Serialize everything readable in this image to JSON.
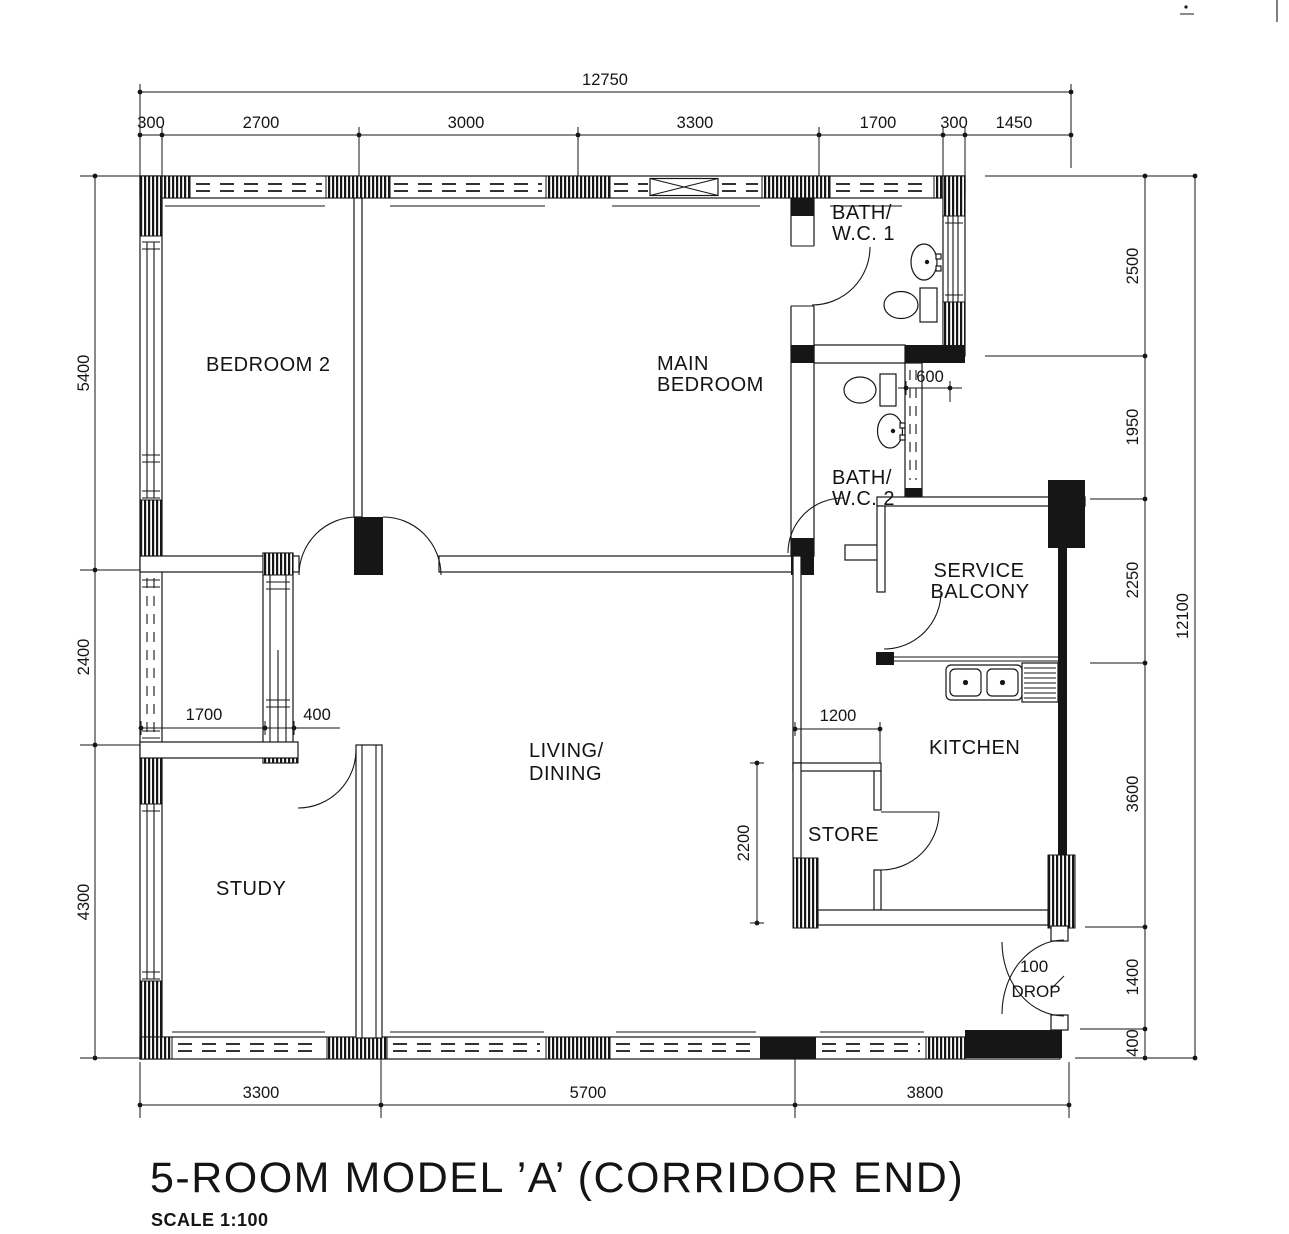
{
  "drawing": {
    "title": "5-ROOM MODEL ’A’ (CORRIDOR END)",
    "scale_label": "SCALE 1:100"
  },
  "rooms": {
    "bedroom2": "BEDROOM 2",
    "main_bedroom_line1": "MAIN",
    "main_bedroom_line2": "BEDROOM",
    "bath1_line1": "BATH/",
    "bath1_line2": "W.C. 1",
    "bath2_line1": "BATH/",
    "bath2_line2": "W.C. 2",
    "service_balcony_line1": "SERVICE",
    "service_balcony_line2": "BALCONY",
    "kitchen": "KITCHEN",
    "store": "STORE",
    "living_line1": "LIVING/",
    "living_line2": "DINING",
    "study": "STUDY",
    "entrance_drop_line1": "100",
    "entrance_drop_line2": "DROP"
  },
  "dimensions": {
    "top_total": "12750",
    "top_segments": [
      "300",
      "2700",
      "3000",
      "3300",
      "1700",
      "300",
      "1450"
    ],
    "left": [
      "5400",
      "2400",
      "4300"
    ],
    "right": [
      "2500",
      "1950",
      "2250",
      "3600",
      "1400",
      "400"
    ],
    "right_total": "12100",
    "bottom": [
      "3300",
      "5700",
      "3800"
    ],
    "interior": {
      "hall_width": "1700",
      "duct_width": "400",
      "bath_step": "600",
      "store_width": "1200",
      "store_depth": "2200"
    }
  }
}
